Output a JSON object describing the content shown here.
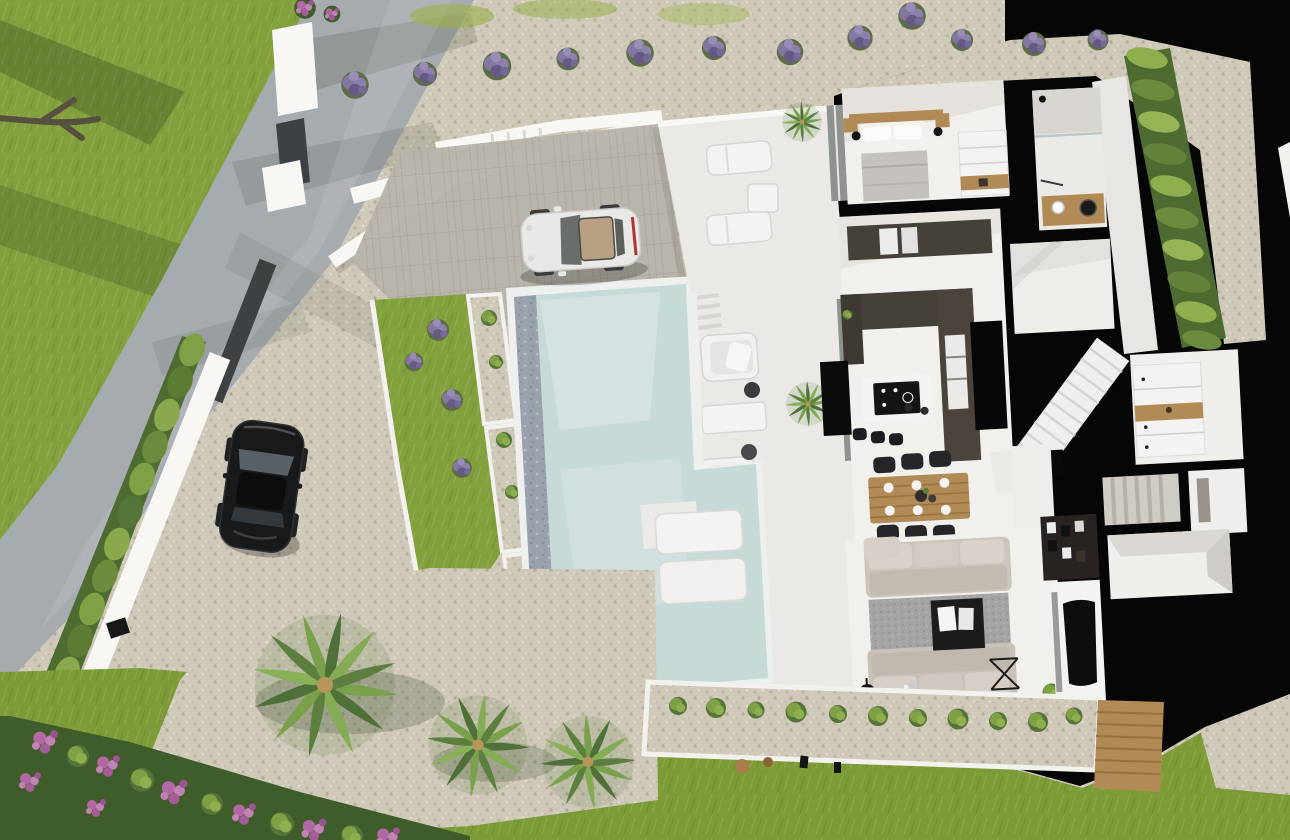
{
  "meta": {
    "description": "Aerial top-down 3D architectural rendering (cutaway floor-plan view) of a modern white villa with swimming pool, driveway, two parked cars and landscaped gardens",
    "render_type": "photorealistic 3D visualization, bird's-eye view",
    "contains_text": false
  },
  "colors": {
    "backdrop_black": "#060606",
    "road": "#a6abb0",
    "lawn": "#82a03c",
    "lawn_bottom": "#7d9b36",
    "gravel": "#cfc9ba",
    "paving": "#b8b4ab",
    "deck": "#ebe9e5",
    "floor": "#f2f0ed",
    "water": "#c6dad8",
    "pebble": "#9aa2ad",
    "hedge": "#6d8b3d",
    "hedge_dark": "#4e6c32",
    "counter_dark": "#46403a",
    "wood": "#b28a56",
    "sofa": "#ccc5bb",
    "rug": "#a5a4a2",
    "glass": "#8e938f",
    "wall_white": "#f8f7f4",
    "wall_dark": "#3e4144",
    "car_white": "#e8e8e6",
    "car_black": "#17191b",
    "media_dark": "#282320",
    "skylight_tan": "#c9b28a",
    "lavender": "#8377a2",
    "flower_pink": "#b168a4",
    "palm_green": "#7aa04c",
    "palm_dark": "#4f7038"
  },
  "scene": {
    "site": [
      {
        "name": "perimeter-road",
        "label": "gray road along upper-left with tree shadows"
      },
      {
        "name": "front-lawn",
        "label": "green lawn left of road"
      },
      {
        "name": "boundary-wall",
        "label": "white boundary wall with trimmed hedge on top"
      },
      {
        "name": "entrance-gate",
        "label": "dark gray gate panel in white wall"
      },
      {
        "name": "driveway",
        "label": "paved + gravel forecourt"
      },
      {
        "name": "stepped-walls",
        "label": "white stepped retaining walls"
      },
      {
        "name": "lavender-row",
        "label": "row of lavender bushes along upper gravel band",
        "count": 12
      },
      {
        "name": "wall-lamp",
        "label": "black exterior wall light"
      }
    ],
    "vehicles": [
      {
        "name": "white-sports-car",
        "label": "white coupe parked on paved drive, tan interior visible through roof"
      },
      {
        "name": "black-car",
        "label": "black car parked on gravel drive"
      }
    ],
    "pool_area": {
      "main_pool": "large rectangular pool, pale blue-green water, dark pebble overflow edge on west side",
      "in_pool_loungers": 2,
      "planter_strip": "white-bordered planters with shrubs and lavender along pool west side",
      "mid_lawn": "grass strip between driveway and pool planters"
    },
    "terraces": {
      "upper_terrace": {
        "loungers": 2,
        "side_table": 1,
        "potted_plant": 1
      },
      "pool_deck": {
        "armchair_loungers": 2,
        "table": 1,
        "round_side_tables": 2,
        "potted_palm": 1
      }
    },
    "house": {
      "style": "cutaway plan, thick black section walls, white floors",
      "rooms": [
        {
          "name": "master-bedroom",
          "items": [
            "double bed",
            "2 wood nightstands",
            "2 black pendant lamps",
            "white wardrobe with wood shelf"
          ]
        },
        {
          "name": "bathroom",
          "items": [
            "shower",
            "wood vanity",
            "round black mirror",
            "white basin"
          ]
        },
        {
          "name": "kitchen",
          "items": [
            "dark U-shaped counter",
            "island with black induction hob",
            "3 black bar stools",
            "black tall unit",
            "built-in white ovens"
          ]
        },
        {
          "name": "main-staircase",
          "items": [
            "white straight stair",
            "black newel block"
          ]
        },
        {
          "name": "entrance-hall",
          "items": []
        },
        {
          "name": "dining-area",
          "items": [
            "wood dining table",
            "6 black chairs",
            "6 white plates"
          ]
        },
        {
          "name": "living-room",
          "items": [
            "2 beige sofas",
            "gray rug",
            "black coffee table",
            "mirror ball",
            "black floor lamp",
            "wine rack",
            "2 floor glass panels"
          ]
        },
        {
          "name": "tv-wall",
          "items": [
            "dark media shelving",
            "white wall",
            "black curved TV"
          ]
        },
        {
          "name": "pantry",
          "items": [
            "white cabinets with wood niche"
          ]
        },
        {
          "name": "service-stair",
          "items": [
            "gray steps"
          ]
        },
        {
          "name": "utility-room",
          "items": [
            "gray mat"
          ]
        },
        {
          "name": "annex-room",
          "items": [
            "empty white room"
          ]
        }
      ]
    },
    "garden": {
      "palm_trees": 3,
      "pink_flower_shrubs": "dense flowering border along bottom-left",
      "south_planter": "white-edged pebble planter with shrub row, 2 rocks, 2 bollard lights",
      "wood_deck": "slatted timber deck at south-east of terrace",
      "east_hedge": "tall green hedge strip along east side",
      "bottom_grass": "lawn band across bottom with gravel corner patch"
    }
  }
}
